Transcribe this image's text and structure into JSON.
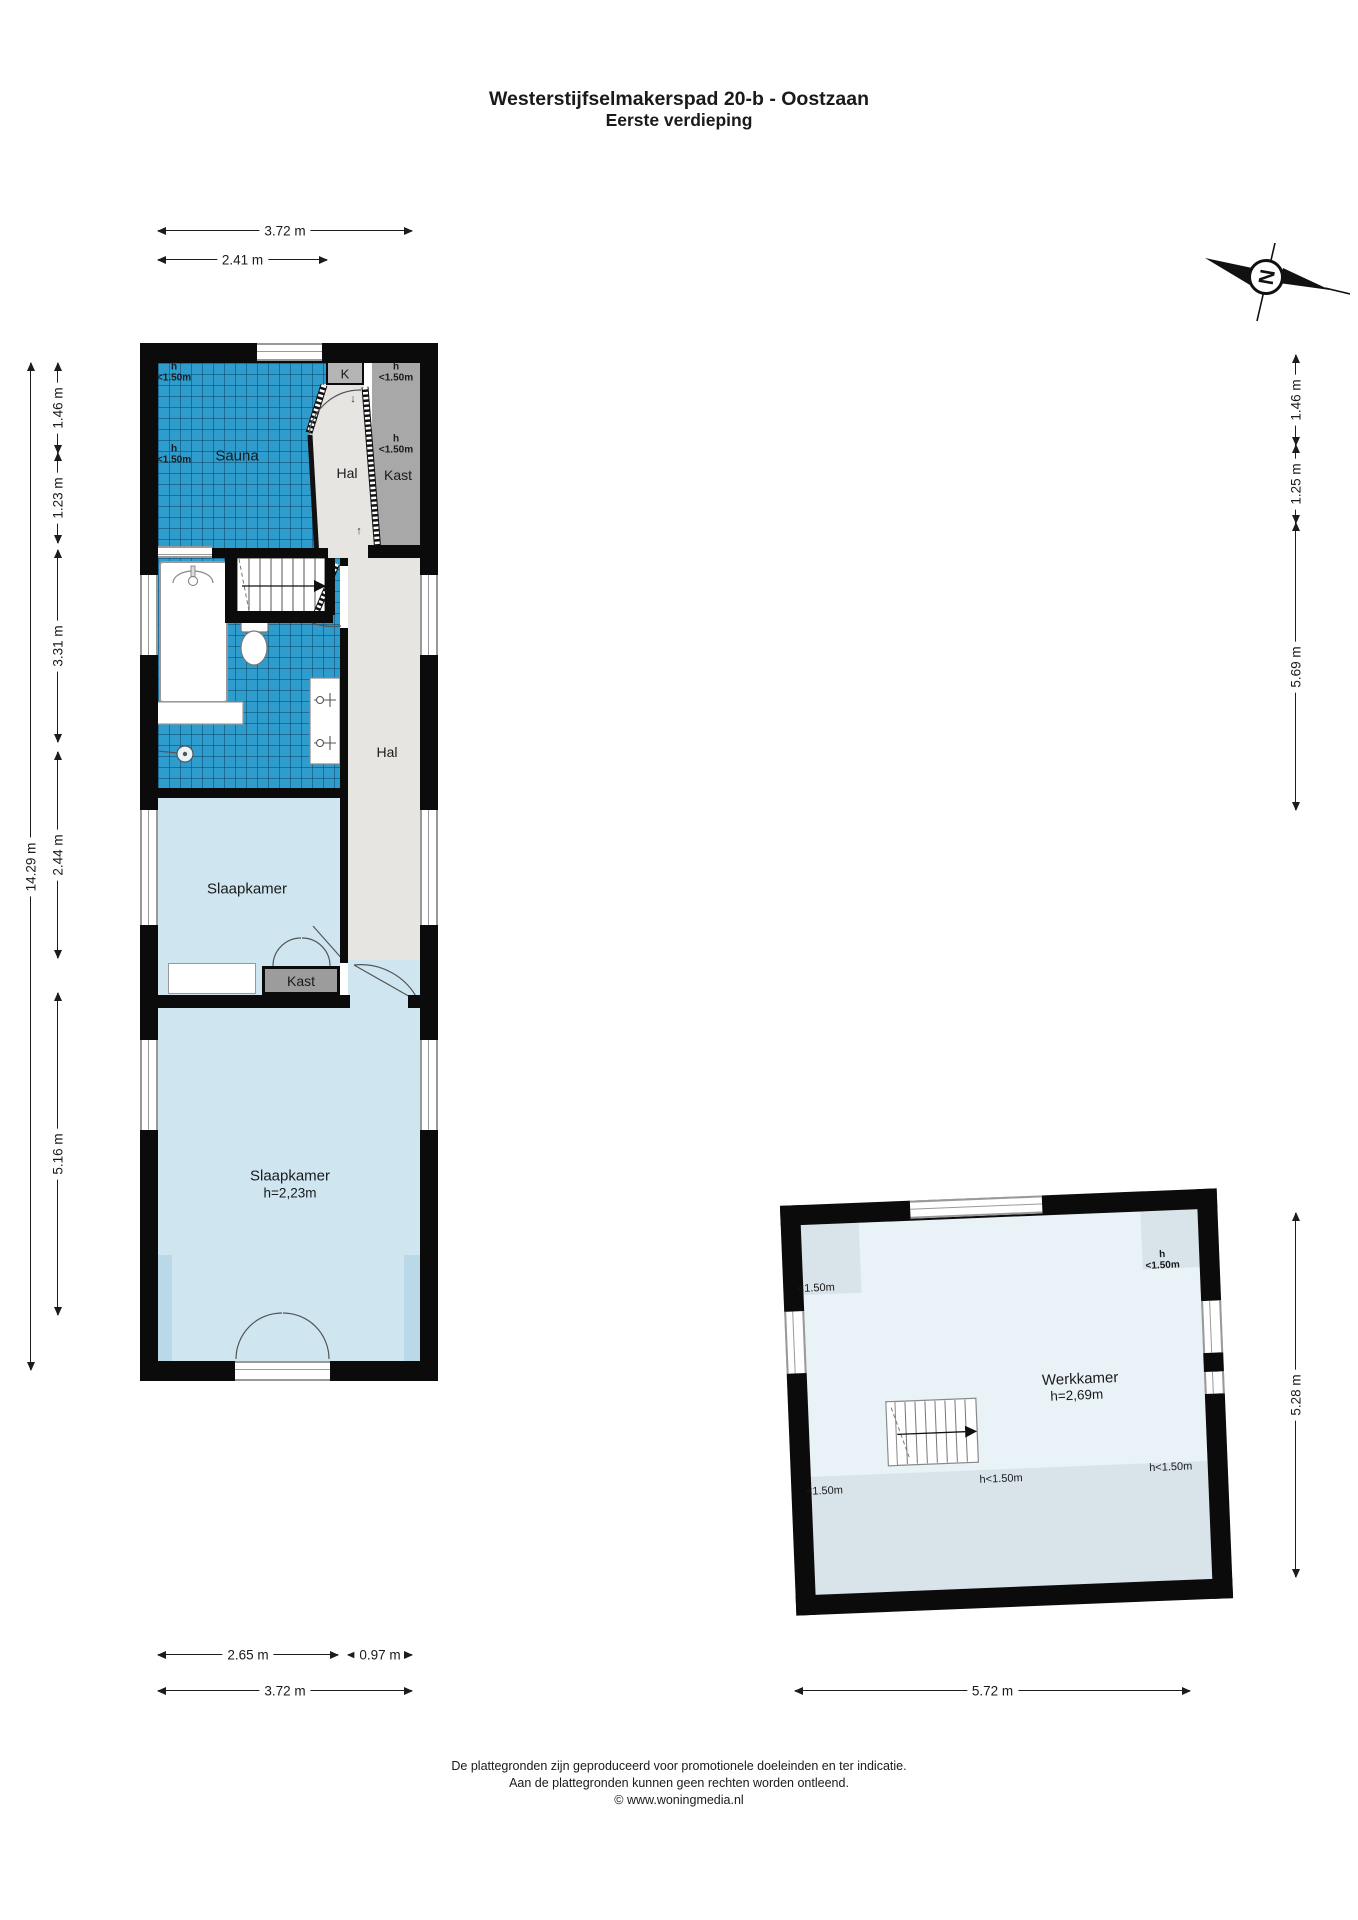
{
  "title": {
    "line1": "Westerstijfselmakerspad 20-b - Oostzaan",
    "line2": "Eerste verdieping"
  },
  "compass": {
    "letter": "N"
  },
  "dims": {
    "top_1": "3.72 m",
    "top_2": "2.41 m",
    "left_total": "14.29 m",
    "left_1": "1.46 m",
    "left_2": "1.23 m",
    "left_3": "3.31 m",
    "left_4": "2.44 m",
    "left_5": "5.16 m",
    "right_1": "1.46 m",
    "right_2": "1.25 m",
    "right_3": "5.69 m",
    "right_4": "5.28 m",
    "bottom_1": "2.65 m",
    "bottom_2": "0.97 m",
    "bottom_3": "3.72 m",
    "bottom_4": "5.72 m"
  },
  "floor": {
    "sauna": "Sauna",
    "h_label": "h",
    "h_value": "<1.50m",
    "k_label": "K",
    "hal_top": "Hal",
    "kast_top": "Kast",
    "hal_mid": "Hal",
    "slaapkamer_1": "Slaapkamer",
    "kast_2": "Kast",
    "slaapkamer_2": "Slaapkamer",
    "slaapkamer_2_height": "h=2,23m",
    "werkkamer": "Werkkamer",
    "werkkamer_height": "h=2,69m",
    "werk_tl": "<1.50m",
    "werk_bl": "<1.50m",
    "werk_bc": "h<1.50m",
    "werk_br": "h<1.50m",
    "arrow_down": "↓",
    "arrow_up": "↑"
  },
  "footer": {
    "line1": "De plattegronden zijn geproduceerd voor promotionele doeleinden en ter indicatie.",
    "line2": "Aan de plattegronden kunnen geen rechten worden ontleend.",
    "line3": "© www.woningmedia.nl"
  },
  "colors": {
    "wall": "#0b0b0b",
    "tile_blue": "#2E9DCE",
    "room_blue": "#cfe6f1",
    "room_blue_shade": "#b9d8e8",
    "hal_gray": "#e6e5e1",
    "kast_gray": "#a8a8a8",
    "werk_blue": "#e9f2f7",
    "werk_shade": "#d8e3ea"
  }
}
